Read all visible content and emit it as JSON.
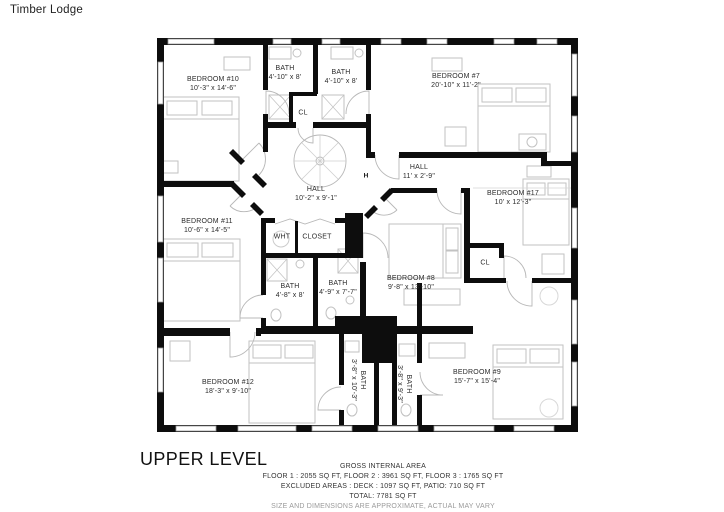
{
  "header": {
    "title": "Timber Lodge"
  },
  "floor_plan": {
    "level_label": "UPPER LEVEL",
    "rooms": [
      {
        "id": "bedroom-10",
        "name": "BEDROOM #10",
        "dims": "10'-3\" x 14'-6\""
      },
      {
        "id": "bath-top-left",
        "name": "BATH",
        "dims": "4'-10\" x 8'"
      },
      {
        "id": "bath-top-right",
        "name": "BATH",
        "dims": "4'-10\" x 8'"
      },
      {
        "id": "closet-top",
        "name": "CL",
        "dims": ""
      },
      {
        "id": "bedroom-7",
        "name": "BEDROOM #7",
        "dims": "20'-10\" x 11'-2\""
      },
      {
        "id": "hall-main",
        "name": "HALL",
        "dims": "10'-2\" x 9'-1\""
      },
      {
        "id": "hall-upper",
        "name": "HALL",
        "dims": "11' x 2'-9\""
      },
      {
        "id": "bedroom-17",
        "name": "BEDROOM #17",
        "dims": "10' x 12'-3\""
      },
      {
        "id": "closet-17",
        "name": "CL",
        "dims": ""
      },
      {
        "id": "bedroom-11",
        "name": "BEDROOM #11",
        "dims": "10'-6\" x 14'-5\""
      },
      {
        "id": "water-heater",
        "name": "WHT",
        "dims": ""
      },
      {
        "id": "closet-main",
        "name": "CLOSET",
        "dims": ""
      },
      {
        "id": "bath-mid-left",
        "name": "BATH",
        "dims": "4'-8\" x 8'"
      },
      {
        "id": "bath-mid-right",
        "name": "BATH",
        "dims": "4'-9\" x 7'-7\""
      },
      {
        "id": "bedroom-8",
        "name": "BEDROOM #8",
        "dims": "9'-8\" x 13'-10\""
      },
      {
        "id": "bedroom-12",
        "name": "BEDROOM #12",
        "dims": "18'-3\" x 9'-10\""
      },
      {
        "id": "bath-bottom-left",
        "name": "BATH",
        "dims": "3'-8\" x 10'-3\""
      },
      {
        "id": "bath-bottom-right",
        "name": "BATH",
        "dims": "3'-8\" x 9'-3\""
      },
      {
        "id": "bedroom-9",
        "name": "BEDROOM #9",
        "dims": "15'-7\" x 15'-4\""
      }
    ],
    "markers": {
      "h_label": "H"
    }
  },
  "footer": {
    "area_title": "GROSS INTERNAL AREA",
    "floors_line": "FLOOR 1 : 2055 SQ FT, FLOOR 2 : 3961 SQ FT, FLOOR 3 : 1765 SQ FT",
    "excluded_line": "EXCLUDED AREAS : DECK : 1097 SQ FT, PATIO: 710 SQ FT",
    "total_line": "TOTAL: 7781 SQ FT",
    "disclaimer": "SIZE AND DIMENSIONS ARE APPROXIMATE, ACTUAL MAY VARY"
  },
  "colors": {
    "wall": "#0d0d0d",
    "furniture_line": "#c2c2c2",
    "text": "#2b2b2b",
    "disclaimer_text": "#9a9a9a"
  }
}
